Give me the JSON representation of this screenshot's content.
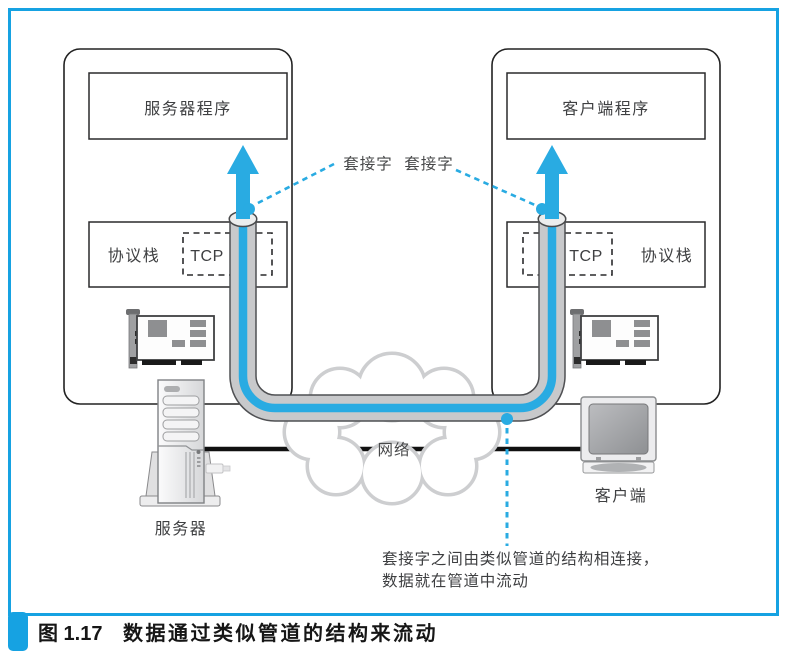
{
  "figure": {
    "caption": {
      "label": "图 1.17",
      "title": "数据通过类似管道的结构来流动"
    }
  },
  "server_host": {
    "program": "服务器程序",
    "protocol_stack": "协议栈",
    "tcp": "TCP",
    "device": "服务器"
  },
  "client_host": {
    "program": "客户端程序",
    "protocol_stack": "协议栈",
    "tcp": "TCP",
    "device": "客户端"
  },
  "annotations": {
    "socket_label_left": "套接字",
    "socket_label_right": "套接字",
    "network": "网络",
    "pipe_note_line1": "套接字之间由类似管道的结构相连接，",
    "pipe_note_line2": "数据就在管道中流动"
  },
  "icons": {
    "nic_card": "network-interface-card",
    "server_tower": "tower-computer",
    "client_monitor": "desktop-crt-monitor",
    "network_cloud": "scalloped-cloud",
    "data_arrow": "upward-blue-arrow",
    "socket_port": "pipe-opening-ellipse"
  },
  "colors": {
    "accent_blue": "#29abe2",
    "frame_blue": "#16a2e2",
    "pipe_gray": "#c8c9cb",
    "pipe_outline": "#4f5053",
    "cloud_gray": "#cdced0",
    "cable_black": "#111111"
  }
}
